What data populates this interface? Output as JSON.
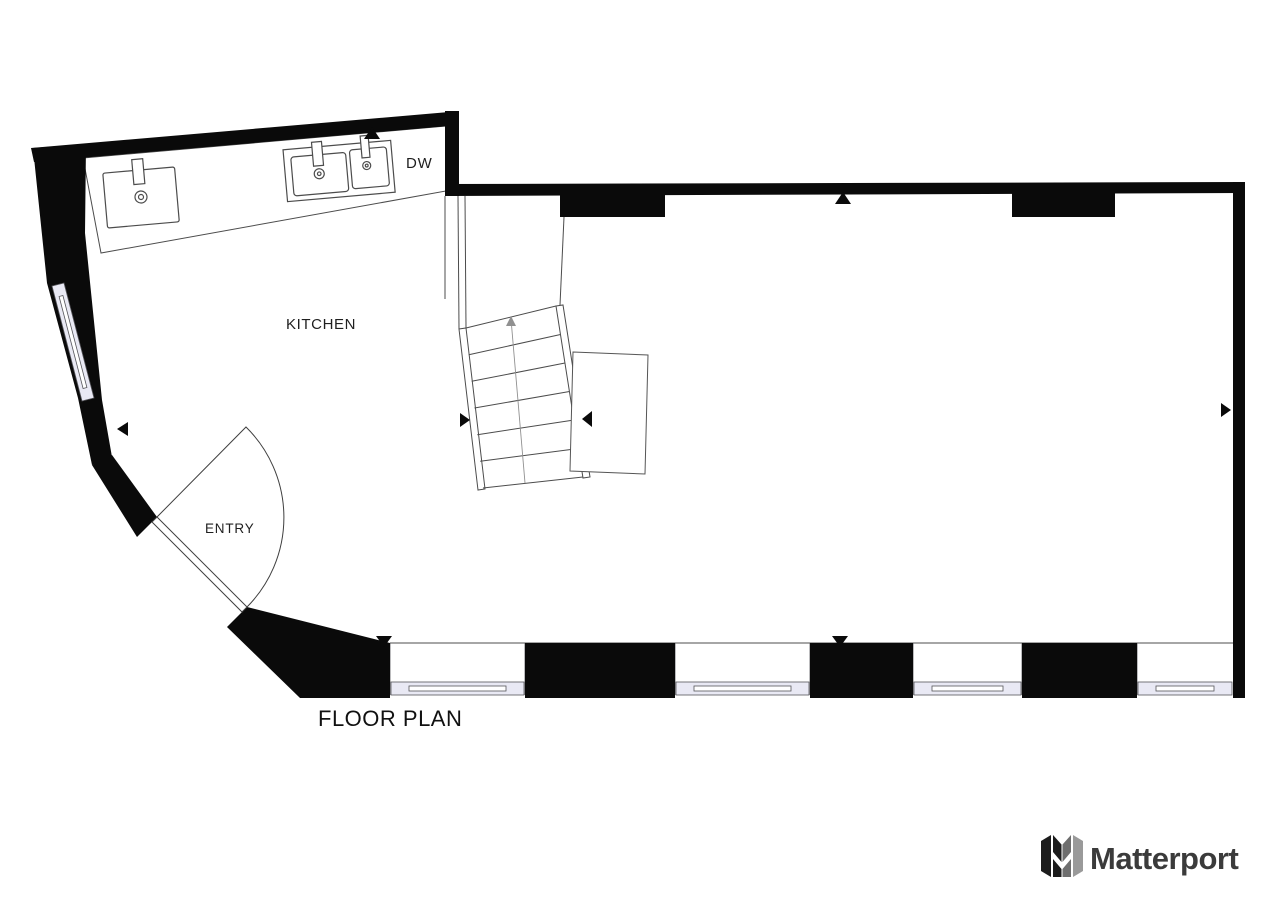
{
  "plan": {
    "title": "FLOOR PLAN",
    "rooms": {
      "kitchen": "KITCHEN",
      "entry": "ENTRY"
    },
    "appliances": {
      "dishwasher": "DW"
    },
    "colors": {
      "wall": "#0a0a0a",
      "line": "#4c4c4c",
      "line_light": "#909090",
      "window": "#e9e9f4",
      "text": "#1f1f1f"
    }
  },
  "branding": {
    "name": "Matterport",
    "colors": {
      "mark_dark": "#1c1c1c",
      "mark_mid": "#6e6e6e",
      "mark_gray": "#9a9a9a",
      "text": "#3b3b3b"
    }
  }
}
